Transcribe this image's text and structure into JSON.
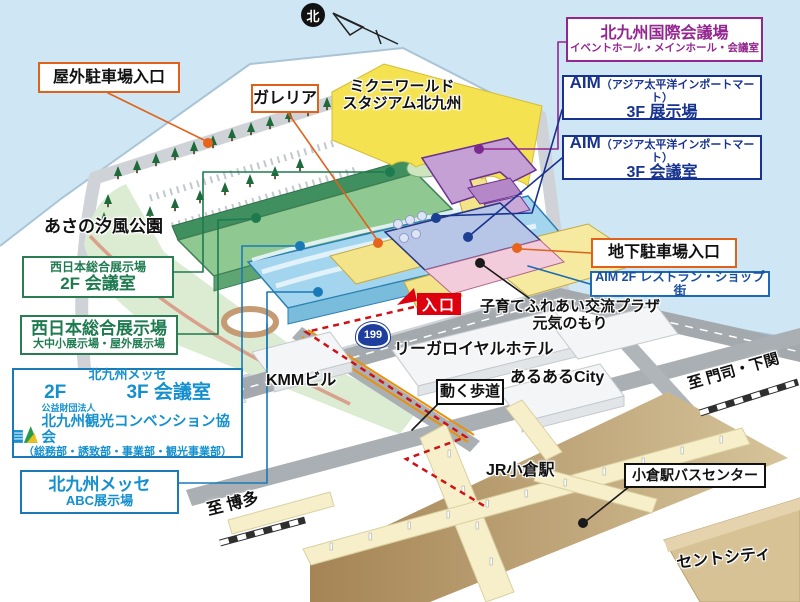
{
  "compass": {
    "north_label": "北"
  },
  "route_badge": {
    "number": "199"
  },
  "map_labels": {
    "entrance": "入口",
    "asano_park": "あさの汐風公園",
    "stadium_line1": "ミクニワールド",
    "stadium_line2": "スタジアム北九州",
    "kosodate_plaza_line1": "子育てふれあい交流プラザ",
    "kosodate_plaza_line2": "元気のもり",
    "rihga_hotel": "リーガロイヤルホテル",
    "kmm_building": "KMMビル",
    "aruaru_city": "あるあるCity",
    "to_moji_shimonoseki": "至 門司・下関",
    "jr_kokura_station": "JR小倉駅",
    "sento_city": "セントシティ",
    "to_hakata": "至 博多"
  },
  "callout_boxes": {
    "outdoor_parking": "屋外駐車場入口",
    "galleria": "ガレリア",
    "intl_conference_center": {
      "line1": "北九州国際会議場",
      "line2": "イベントホール・メインホール・会議室"
    },
    "aim_3f_exhibition": {
      "name": "AIM",
      "paren": "（アジア太平洋インポートマート）",
      "floor": "3F 展示場"
    },
    "aim_3f_meeting": {
      "name": "AIM",
      "paren": "（アジア太平洋インポートマート）",
      "floor": "3F 会議室"
    },
    "underground_parking": "地下駐車場入口",
    "aim_2f_restaurant": "AIM 2F レストラン・ショップ街",
    "nishinihon_2f_meeting": {
      "line1": "西日本総合展示場",
      "line2": "2F 会議室"
    },
    "nishinihon_exhibition": {
      "line1": "西日本総合展示場",
      "line2": "大中小展示場・屋外展示場"
    },
    "kitakyushu_messe": {
      "title": "北九州メッセ",
      "floor_left": "2F",
      "floor_right": "3F 会議室",
      "org_type": "公益財団法人",
      "org_name": "北九州観光コンベンション協会",
      "org_depts": "（総務部・誘致部・事業部・観光事業部）"
    },
    "messe_abc": {
      "line1": "北九州メッセ",
      "line2": "ABC展示場"
    },
    "moving_walkway": "動く歩道",
    "bus_center": "小倉駅バスセンター"
  },
  "colors": {
    "water": "#cfe6f4",
    "orange_accent": "#e0621a",
    "green_accent": "#1e7a4f",
    "blue_accent": "#1590cf",
    "navy_accent": "#17338f",
    "purple_accent": "#93278f",
    "red_route": "#cf1015",
    "entrance_red": "#dd000f",
    "badge_blue": "#1f3f9e"
  }
}
